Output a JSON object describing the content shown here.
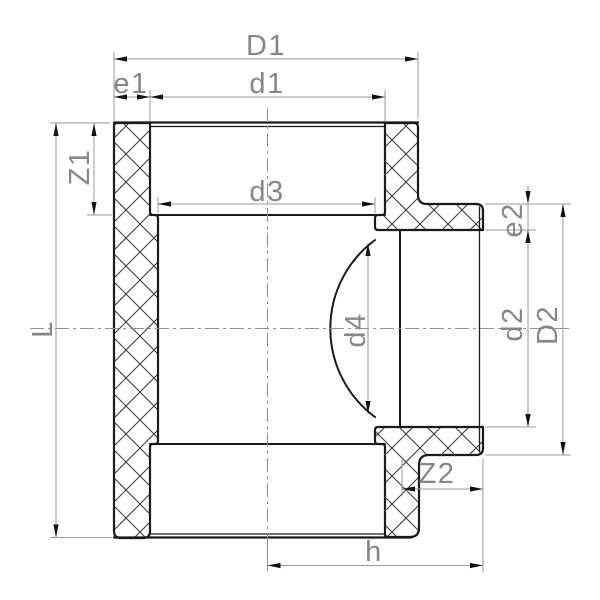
{
  "drawing": {
    "title": "pipe-tee-fitting-section",
    "colors": {
      "background": "#ffffff",
      "outline": "#1a1a1a",
      "hatch": "#3d3d3d",
      "dimension_lines": "#999999",
      "arrowheads": "#111111",
      "labels": "#868686",
      "centerlines": "#8f8f8f"
    },
    "dims": {
      "D1": {
        "label": "D1"
      },
      "d1": {
        "label": "d1"
      },
      "e1": {
        "label": "e1"
      },
      "Z1": {
        "label": "Z1"
      },
      "L": {
        "label": "L"
      },
      "d3": {
        "label": "d3"
      },
      "d4": {
        "label": "d4"
      },
      "e2": {
        "label": "e2"
      },
      "d2": {
        "label": "d2"
      },
      "D2": {
        "label": "D2"
      },
      "Z2": {
        "label": "Z2"
      },
      "h": {
        "label": "h"
      }
    }
  }
}
